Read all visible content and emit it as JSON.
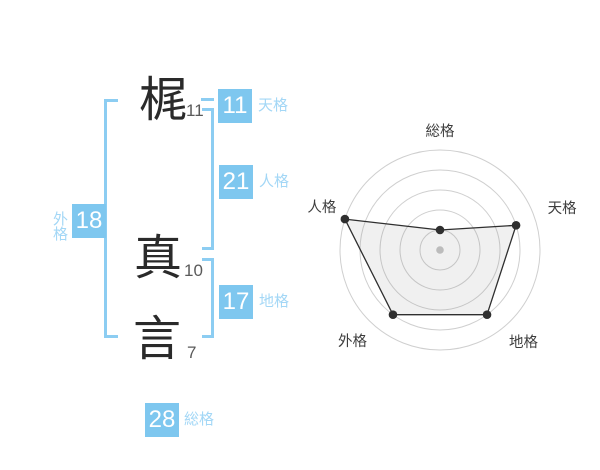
{
  "name_panel": {
    "characters": [
      {
        "char": "梶",
        "strokes": "11"
      },
      {
        "char": "真",
        "strokes": "10"
      },
      {
        "char": "言",
        "strokes": "7"
      }
    ],
    "grids": {
      "tenkaku": {
        "value": "11",
        "label": "天格"
      },
      "jinkaku": {
        "value": "21",
        "label": "人格"
      },
      "chikaku": {
        "value": "17",
        "label": "地格"
      },
      "gaikaku": {
        "value": "18",
        "label": "外格"
      },
      "soukaku": {
        "value": "28",
        "label": "総格"
      }
    }
  },
  "colors": {
    "accent_blue": "#7ec7ef",
    "label_blue": "#a3d7f6",
    "bracket_blue": "#8ccdf2",
    "ink": "#2f2f2f",
    "ring_gray": "#cfcfcf",
    "center_dot_gray": "#bcbcbc"
  },
  "chart_data": {
    "type": "radar",
    "categories": [
      "総格",
      "天格",
      "地格",
      "外格",
      "人格"
    ],
    "values": [
      20,
      80,
      80,
      80,
      100
    ],
    "max": 100,
    "rings": 5,
    "start_angle_deg": 90,
    "direction": "clockwise",
    "grid": "circular-rings-no-spokes",
    "legend": false,
    "fill": "light-gray",
    "point_markers": true
  }
}
